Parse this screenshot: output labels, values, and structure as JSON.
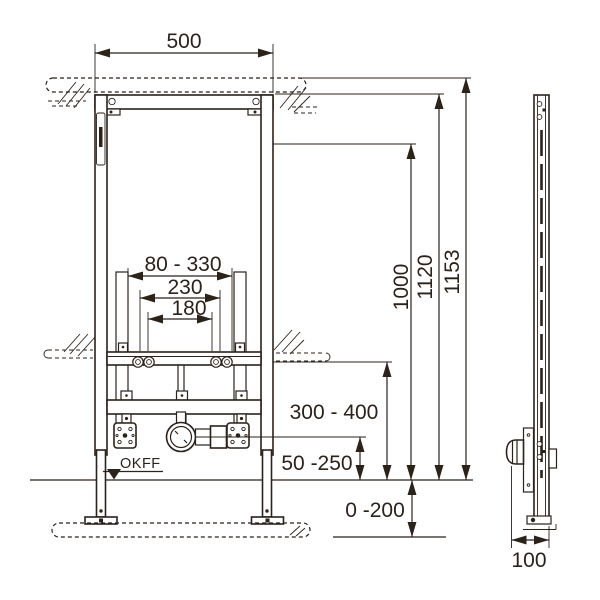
{
  "drawing": {
    "front_view": {
      "frame_width": "500",
      "connection_range": "80 - 330",
      "connection_outer": "230",
      "connection_inner": "180",
      "height_1000": "1000",
      "height_1120": "1120",
      "height_total": "1153",
      "drain_height_range": "300 - 400",
      "outlet_height_range": "50 -250",
      "floor_buildup_range": "0 -200",
      "floor_level_label": "OKFF"
    },
    "side_view": {
      "depth": "100"
    }
  },
  "colors": {
    "line": "#2b221a",
    "background": "#ffffff"
  }
}
